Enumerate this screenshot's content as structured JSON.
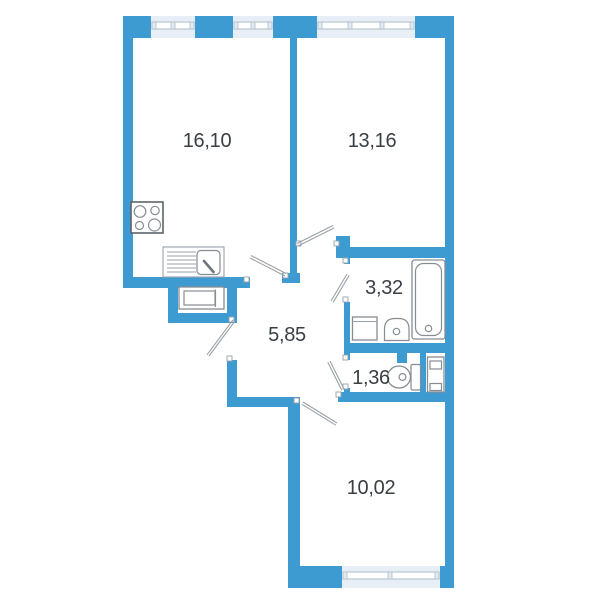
{
  "plan_title": "apartment-floor-plan",
  "colors": {
    "wall": "#3d9bd2",
    "window_fill": "#e7eef6",
    "window_frame": "#aebdca",
    "fixture_line": "#868d93",
    "door_swing": "#9aa2a9",
    "label": "#3a3f44",
    "background": "#ffffff"
  },
  "rooms": [
    {
      "name": "kitchen-living-room",
      "area_label": "16,10"
    },
    {
      "name": "bedroom",
      "area_label": "13,16"
    },
    {
      "name": "bathroom",
      "area_label": "3,32"
    },
    {
      "name": "hallway",
      "area_label": "5,85"
    },
    {
      "name": "wc",
      "area_label": "1,36"
    },
    {
      "name": "bedroom-2",
      "area_label": "10,02"
    }
  ],
  "fixtures": [
    "stove",
    "kitchen-sink-counter",
    "hall-cabinet",
    "bathtub",
    "washbasin",
    "washing-machine",
    "toilet",
    "utility-appliance"
  ],
  "windows_count": 4,
  "door_swings_count": 6
}
